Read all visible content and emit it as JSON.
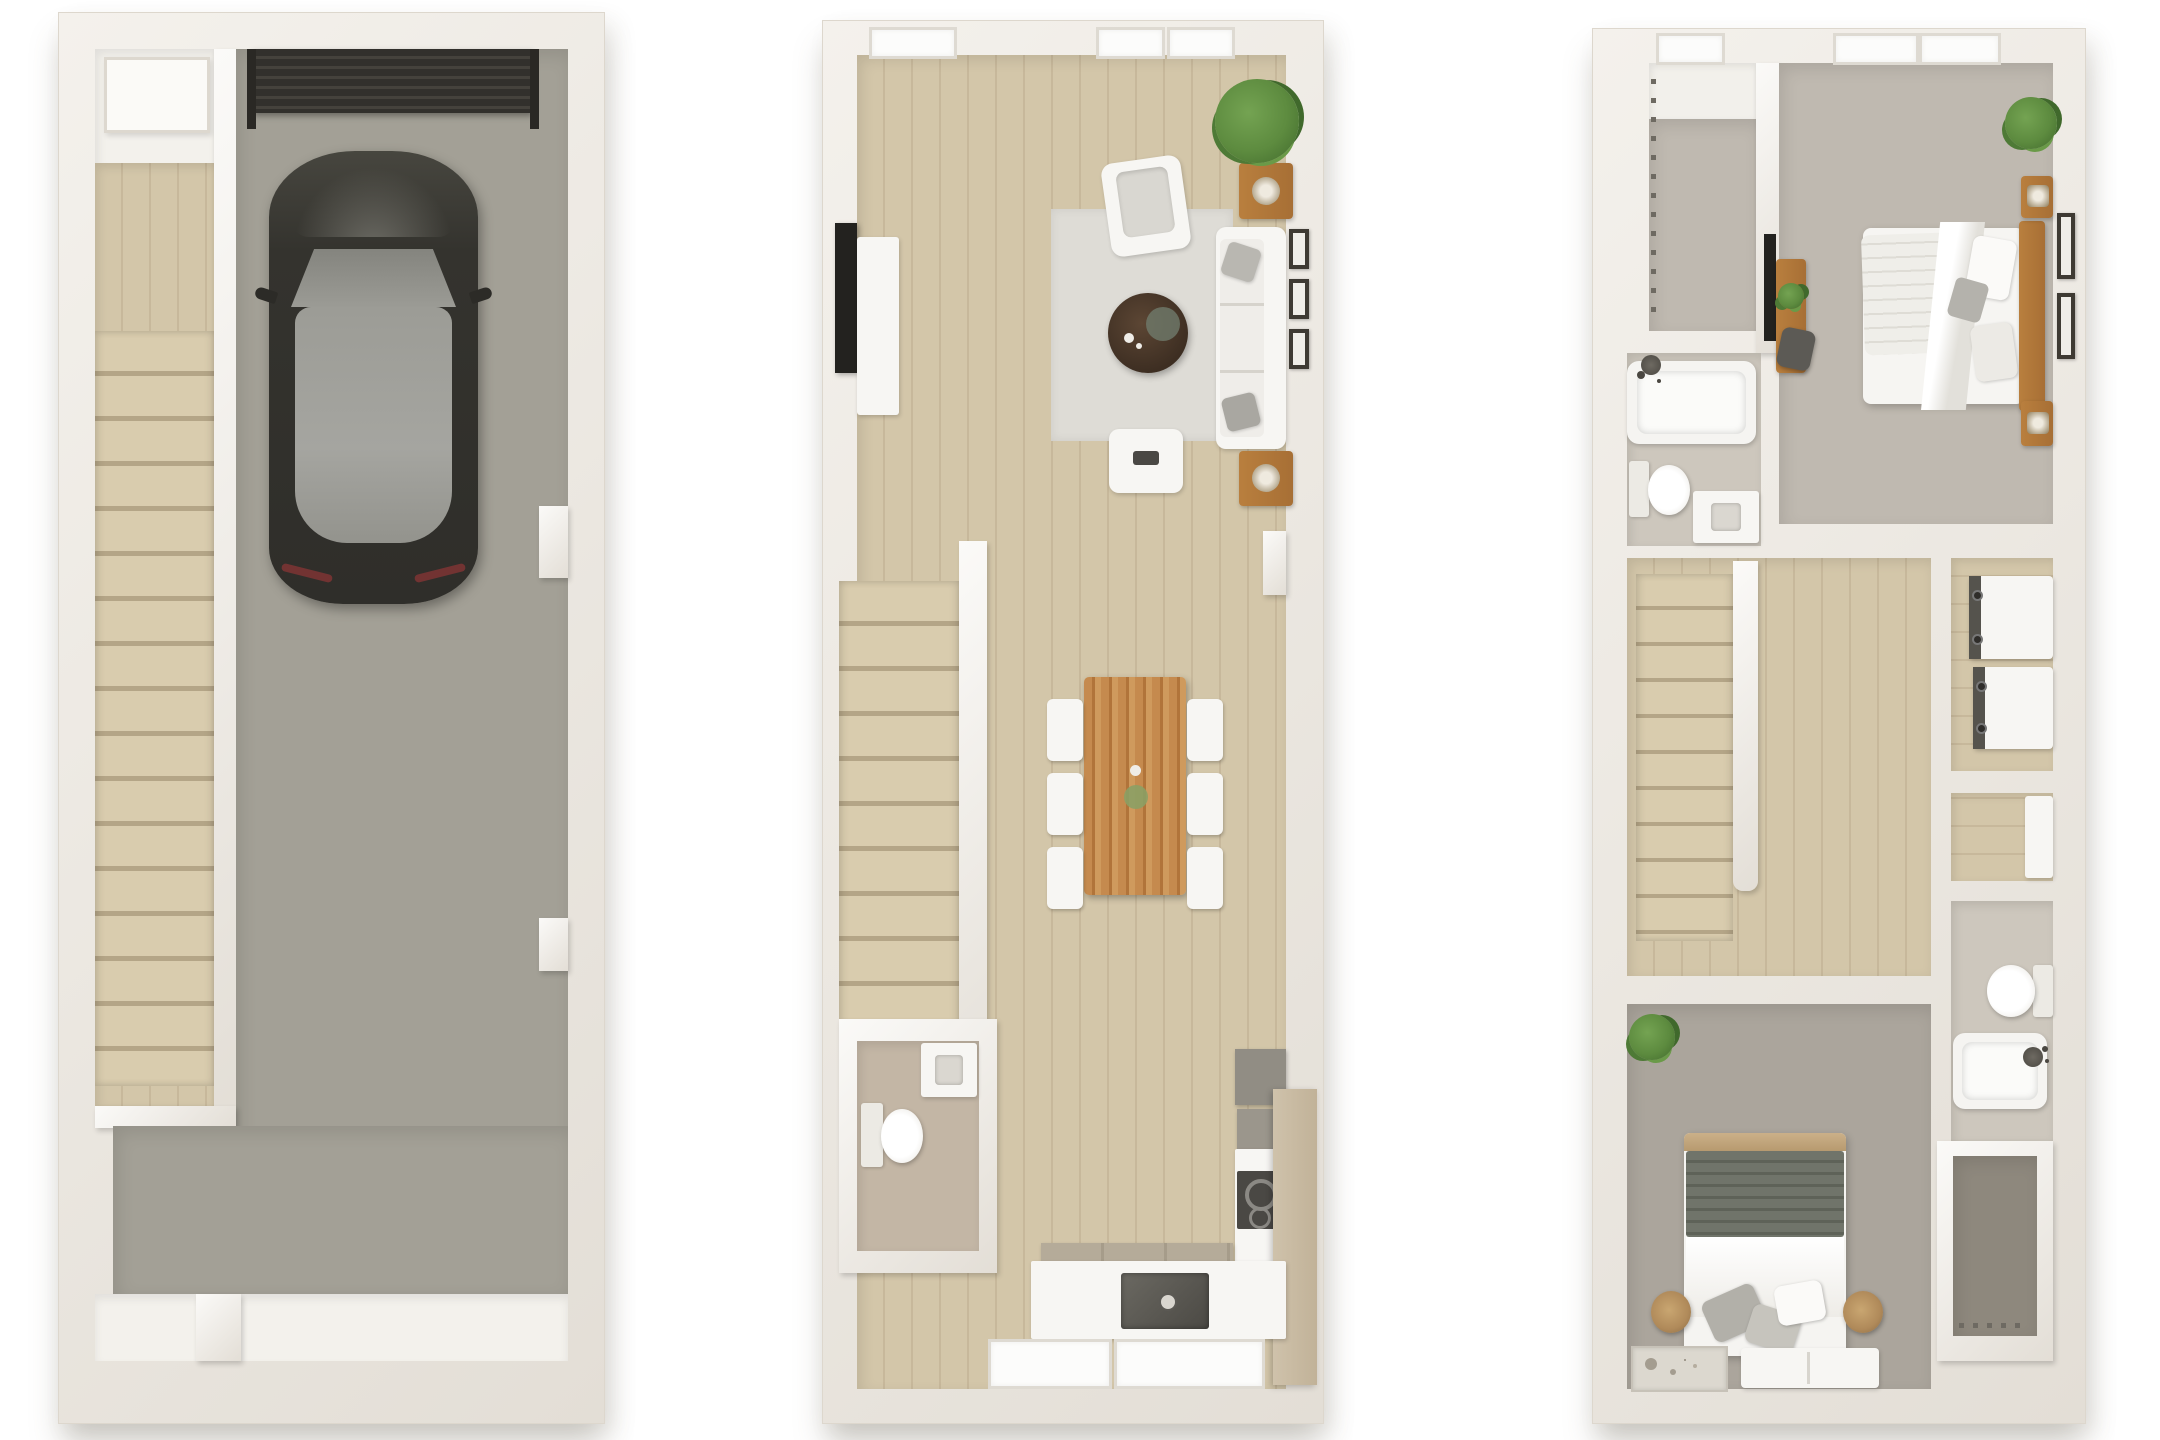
{
  "title_visible_text": "",
  "palette": {
    "bg": "#ffffff",
    "wall": "#f4f1ec",
    "wall_shade": "#e3ded6",
    "wall_line": "#ddd7cd",
    "wood": "#d3c6a9",
    "wood_seam": "#c7b89b",
    "stair": "#d9ccae",
    "stair_edge": "#b4a587",
    "concrete": "#a3a096",
    "concrete2": "#989589",
    "carpet1": "#bfb9b0",
    "carpet2": "#aba59c",
    "carpet3": "#8e887d",
    "tile": "#c3b6a5",
    "bath_floor": "#cdc7bd",
    "rug": "#dedcd6",
    "white_fix": "#f7f6f3",
    "cushion": "#d9d7d1",
    "window": "#fcfcfb",
    "wood_table": "#c0844a",
    "wood_desk": "#b97f3e",
    "coffee": "#3d2e22",
    "plant1": "#5d8b3f",
    "plant2": "#40692c",
    "garage_door": "#32302c",
    "car_body": "#35342f",
    "car_glass": "#9c9c96",
    "counter_gray": "#918d84",
    "appliance": "#55534d",
    "pantry": "#cfc2ab",
    "frame": "#3e3a33",
    "lamp": "#b08a5a",
    "blanket": "#70746a"
  },
  "floors": [
    {
      "id": "level-1",
      "rooms": [
        {
          "name": "entry-hall",
          "items": [
            "front-door",
            "staircase-down"
          ]
        },
        {
          "name": "garage",
          "items": [
            "garage-door",
            "car"
          ]
        },
        {
          "name": "flex-room",
          "items": [
            "door-opening"
          ]
        }
      ]
    },
    {
      "id": "level-2",
      "rooms": [
        {
          "name": "living-room",
          "items": [
            "sofa",
            "armchair",
            "ottoman",
            "coffee-table",
            "area-rug",
            "tv",
            "media-console",
            "side-table",
            "side-table",
            "wall-art",
            "wall-art",
            "wall-art",
            "plant",
            "window",
            "window",
            "window"
          ]
        },
        {
          "name": "dining-area",
          "items": [
            "dining-table",
            "dining-chair",
            "dining-chair",
            "dining-chair",
            "dining-chair",
            "dining-chair",
            "dining-chair",
            "bowl"
          ]
        },
        {
          "name": "staircase",
          "items": [
            "railing-wall"
          ]
        },
        {
          "name": "powder-room",
          "items": [
            "toilet",
            "vanity"
          ]
        },
        {
          "name": "kitchen",
          "items": [
            "refrigerator",
            "cooktop",
            "counter",
            "sink",
            "faucet",
            "pantry-cabinet",
            "window-wall"
          ]
        }
      ]
    },
    {
      "id": "level-3",
      "rooms": [
        {
          "name": "walk-in-closet",
          "items": [
            "hanging-rod",
            "window"
          ]
        },
        {
          "name": "bathroom-1",
          "items": [
            "bathtub",
            "shower-fixture",
            "toilet",
            "vanity"
          ]
        },
        {
          "name": "primary-bedroom",
          "items": [
            "bed",
            "headboard",
            "nightstand",
            "nightstand",
            "lamp",
            "lamp",
            "wall-art",
            "wall-art",
            "plant",
            "desk",
            "desk-plant",
            "desk-chair",
            "tv",
            "window",
            "window"
          ]
        },
        {
          "name": "hall",
          "items": [
            "staircase",
            "railing-wall"
          ]
        },
        {
          "name": "laundry-closet",
          "items": [
            "washer",
            "dryer"
          ]
        },
        {
          "name": "linen-closet",
          "items": [
            "cabinet"
          ]
        },
        {
          "name": "bathroom-2",
          "items": [
            "toilet",
            "bathtub",
            "shower-fixture"
          ]
        },
        {
          "name": "closet-2",
          "items": [
            "hanging-rod"
          ]
        },
        {
          "name": "bedroom-2",
          "items": [
            "bed",
            "blanket",
            "pillows",
            "lamp",
            "lamp",
            "bench",
            "rug",
            "plant"
          ]
        }
      ]
    }
  ]
}
